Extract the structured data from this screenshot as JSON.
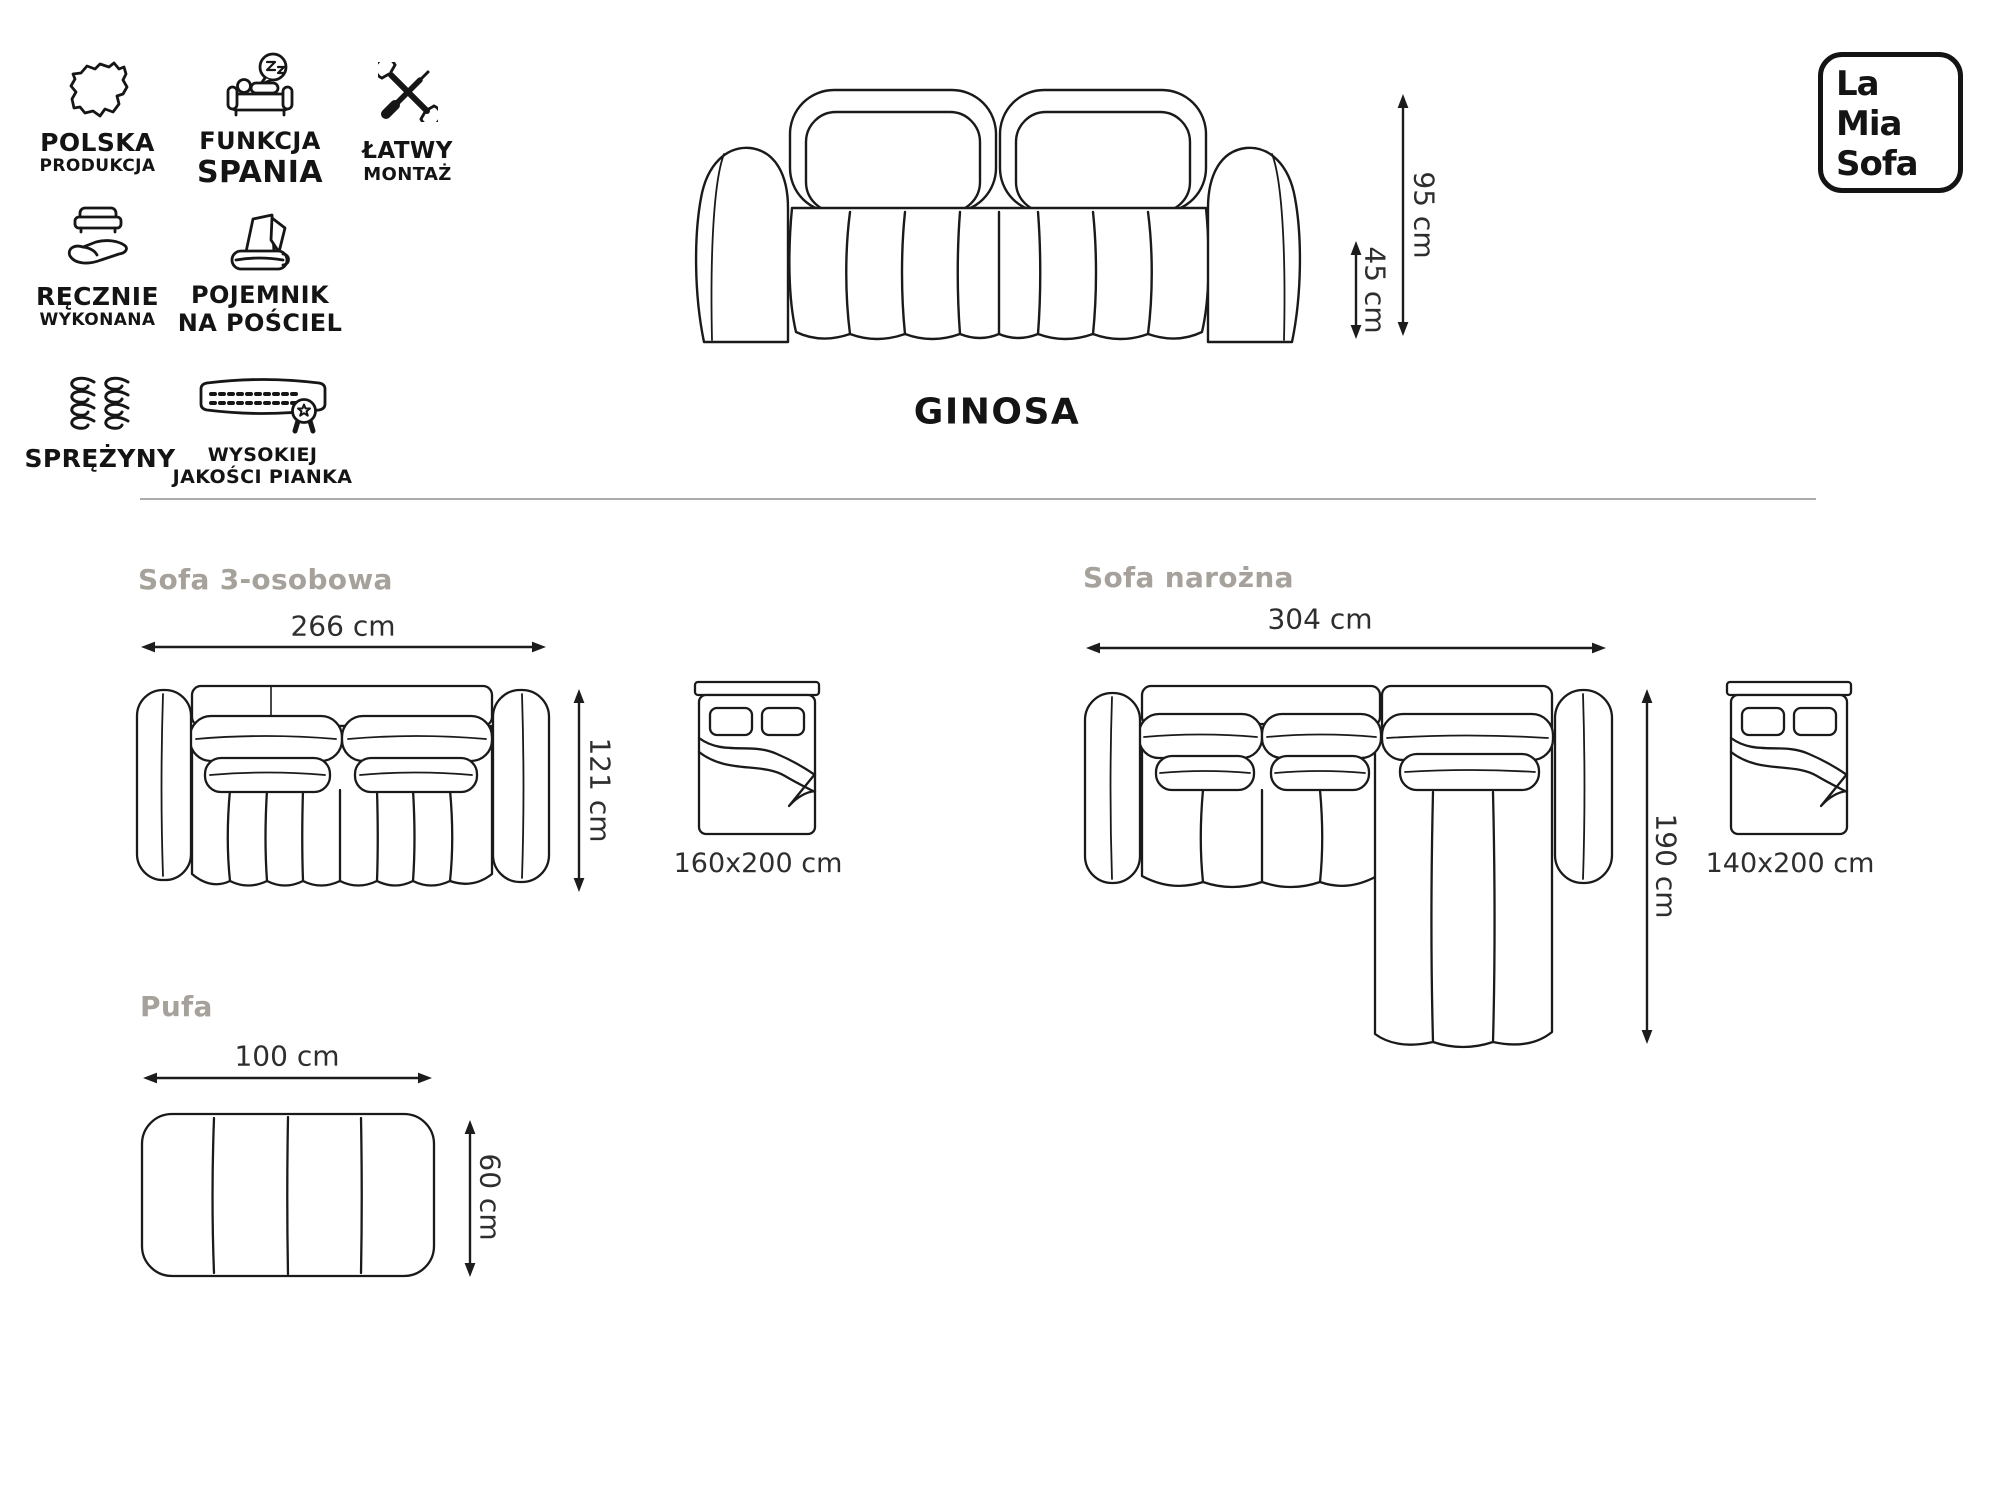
{
  "brand": {
    "line1": "La",
    "line2": "Mia",
    "line3": "Sofa"
  },
  "product": {
    "name": "GINOSA"
  },
  "features": {
    "polska": {
      "line1": "POLSKA",
      "line2": "PRODUKCJA"
    },
    "spanie": {
      "line1": "FUNKCJA",
      "line2": "SPANIA"
    },
    "montaz": {
      "line1": "ŁATWY",
      "line2": "MONTAŻ"
    },
    "recznie": {
      "line1": "RĘCZNIE",
      "line2": "WYKONANA"
    },
    "pojemnik": {
      "line1": "POJEMNIK",
      "line2": "NA POŚCIEL"
    },
    "sprezyny": {
      "line1": "SPRĘŻYNY"
    },
    "pianka": {
      "line1": "WYSOKIEJ",
      "line2": "JAKOŚCI PIANKA"
    }
  },
  "front_view": {
    "total_height": "95 cm",
    "seat_height": "45 cm"
  },
  "variants": {
    "sofa3": {
      "title": "Sofa 3-osobowa",
      "width": "266 cm",
      "depth": "121 cm",
      "sleeping_area": "160x200 cm"
    },
    "corner": {
      "title": "Sofa narożna",
      "width": "304 cm",
      "depth": "190 cm",
      "sleeping_area": "140x200 cm"
    },
    "pufa": {
      "title": "Pufa",
      "width": "100 cm",
      "depth": "60 cm"
    }
  },
  "colors": {
    "line": "#1a1a1a",
    "label_gray": "#a6a29b",
    "divider": "#ababab",
    "text_dark": "#2e2e2e"
  }
}
